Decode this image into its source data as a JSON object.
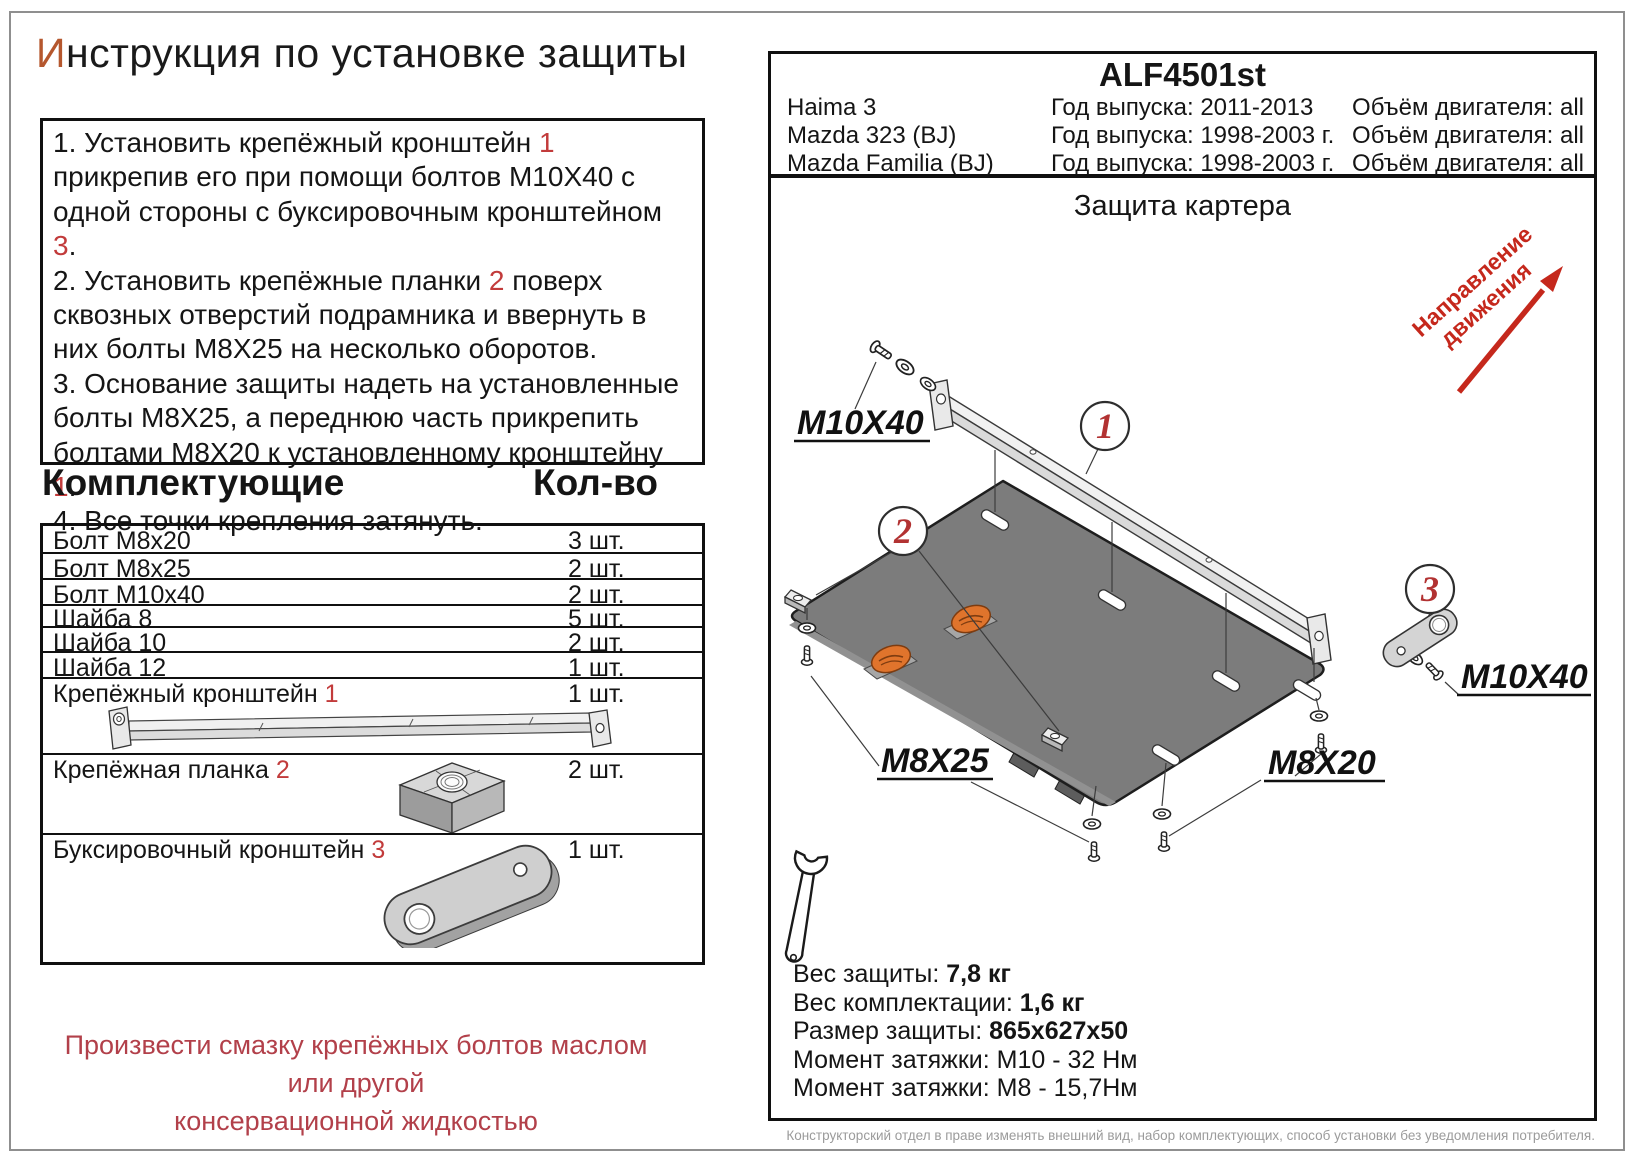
{
  "page": {
    "title_initial": "И",
    "title_rest": "нструкция по установке защиты",
    "footer_note": "Конструкторский отдел в праве изменять внешний вид, набор комплектующих, способ установки без уведомления потребителя."
  },
  "instructions": {
    "steps": [
      {
        "segments": [
          {
            "text": "1.  Установить крепёжный кронштейн "
          },
          {
            "text": "1",
            "red": true
          },
          {
            "text": " прикрепив его при помощи болтов М10Х40 с одной стороны с буксировочным кронштейном "
          },
          {
            "text": "3",
            "red": true
          },
          {
            "text": "."
          }
        ]
      },
      {
        "segments": [
          {
            "text": "2.  Установить крепёжные планки "
          },
          {
            "text": "2",
            "red": true
          },
          {
            "text": " поверх сквозных отверстий подрамника и ввернуть в них болты М8Х25 на несколько оборотов."
          }
        ]
      },
      {
        "segments": [
          {
            "text": "3.  Основание защиты надеть на установленные болты М8Х25, а переднюю часть прикрепить болтами М8Х20 к установленному кронштейну "
          },
          {
            "text": "1",
            "red": true
          },
          {
            "text": "."
          }
        ]
      },
      {
        "segments": [
          {
            "text": "4.  Все точки крепления затянуть."
          }
        ]
      }
    ]
  },
  "parts": {
    "header_name": "Комплектующие",
    "header_qty": "Кол-во",
    "rows": [
      {
        "name": "Болт М8х20",
        "num": "",
        "qty": "3 шт."
      },
      {
        "name": "Болт М8х25",
        "num": "",
        "qty": "2 шт."
      },
      {
        "name": "Болт М10х40",
        "num": "",
        "qty": "2 шт."
      },
      {
        "name": "Шайба 8",
        "num": "",
        "qty": "5 шт."
      },
      {
        "name": "Шайба 10",
        "num": "",
        "qty": "2 шт."
      },
      {
        "name": "Шайба 12",
        "num": "",
        "qty": "1 шт."
      },
      {
        "name": "Крепёжный кронштейн ",
        "num": "1",
        "qty": "1 шт."
      },
      {
        "name": "Крепёжная планка ",
        "num": "2",
        "qty": "2 шт."
      },
      {
        "name": "Буксировочный кронштейн ",
        "num": "3",
        "qty": "1 шт."
      }
    ]
  },
  "lubrication_note": {
    "line1": "Произвести смазку крепёжных болтов маслом или другой",
    "line2": "консервационной жидкостью"
  },
  "product": {
    "code": "ALF4501st",
    "vehicles": [
      {
        "model": "Haima 3",
        "years": "Год выпуска: 2011-2013",
        "engine": "Объём двигателя: all"
      },
      {
        "model": "Mazda 323 (BJ)",
        "years": "Год выпуска: 1998-2003 г.",
        "engine": "Объём двигателя: all"
      },
      {
        "model": "Mazda Familia (BJ)",
        "years": "Год выпуска: 1998-2003 г.",
        "engine": "Объём двигателя: all"
      }
    ]
  },
  "diagram": {
    "title": "Защита картера",
    "direction_line1": "Направление",
    "direction_line2": "движения",
    "labels": {
      "bolt_top_left": "M10X40",
      "bolt_right": "M10X40",
      "bolt_rear": "M8X25",
      "bolt_front": "M8X20"
    },
    "callout_1": "1",
    "callout_2": "2",
    "callout_3": "3"
  },
  "specs": {
    "weight_label": "Вес защиты: ",
    "weight_value": "7,8 кг",
    "kit_weight_label": "Вес комплектации: ",
    "kit_weight_value": "1,6 кг",
    "size_label": "Размер защиты: ",
    "size_value": "865х627х50",
    "torque1_label": "Момент затяжки:  ",
    "torque1_value": "М10 - 32 Нм",
    "torque2_label": "Момент затяжки:  ",
    "torque2_value": "М8 - 15,7Нм"
  },
  "colors": {
    "accent_number_red": "#c23b3b",
    "note_red": "#b2404a",
    "arrow_red": "#c5281c",
    "title_initial": "#b5572e",
    "plate_gray": "#7c7c7c",
    "logo_orange": "#e0742c",
    "footer_gray": "#9b9b9b"
  }
}
